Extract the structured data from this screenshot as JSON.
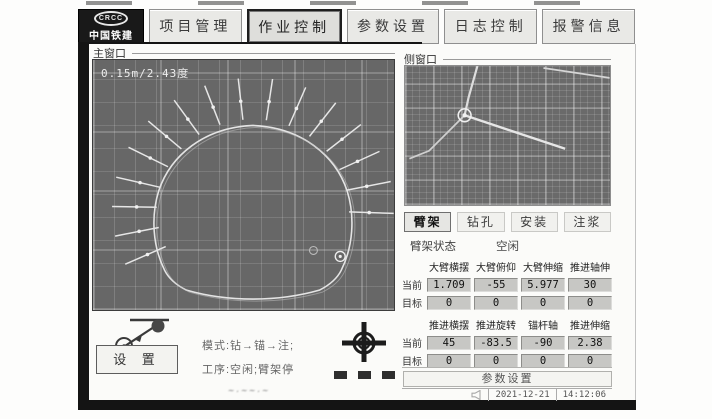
{
  "brand": {
    "name": "中国铁建",
    "emblem": "CRCC"
  },
  "tabs": [
    {
      "name": "project-management",
      "label": "项目管理",
      "active": false
    },
    {
      "name": "operation-control",
      "label": "作业控制",
      "active": true
    },
    {
      "name": "parameter-settings",
      "label": "参数设置",
      "active": false
    },
    {
      "name": "log-control",
      "label": "日志控制",
      "active": false
    },
    {
      "name": "alarm-info",
      "label": "报警信息",
      "active": false
    }
  ],
  "main_window": {
    "title": "主窗口",
    "overlay_text": "0.15m/2.43度",
    "bolt_angles": [
      205,
      192,
      179,
      166,
      152,
      138,
      124,
      110,
      96,
      82,
      68,
      54,
      40,
      26,
      12,
      -2
    ]
  },
  "side_window": {
    "title": "侧窗口"
  },
  "arm_panel": {
    "mode_buttons": [
      {
        "name": "mode-boom",
        "label": "臂架",
        "active": true
      },
      {
        "name": "mode-drill",
        "label": "钻孔",
        "active": false
      },
      {
        "name": "mode-install",
        "label": "安装",
        "active": false
      },
      {
        "name": "mode-grout",
        "label": "注浆",
        "active": false
      }
    ],
    "status_label": "臂架状态",
    "status_value": "空闲"
  },
  "axis_tables": [
    {
      "headers": [
        "大臂横摆",
        "大臂俯仰",
        "大臂伸缩",
        "推进轴伸"
      ],
      "rows": [
        {
          "label": "当前",
          "values": [
            "1.709",
            "-55",
            "5.977",
            "30"
          ]
        },
        {
          "label": "目标",
          "values": [
            "0",
            "0",
            "0",
            "0"
          ]
        }
      ]
    },
    {
      "headers": [
        "推进横摆",
        "推进旋转",
        "锚杆轴",
        "推进伸缩"
      ],
      "rows": [
        {
          "label": "当前",
          "values": [
            "45",
            "-83.5",
            "-90",
            "2.38"
          ]
        },
        {
          "label": "目标",
          "values": [
            "0",
            "0",
            "0",
            "0"
          ]
        }
      ]
    }
  ],
  "left_controls": {
    "setup_button": "设 置",
    "mode_text": "模式:钻→锚→注;",
    "step_text": "工序:空闲;臂架停"
  },
  "params_button": "参数设置",
  "status_bar": {
    "date": "2021-12-21",
    "time": "14:12:06"
  },
  "watermark": "~·~~·~"
}
